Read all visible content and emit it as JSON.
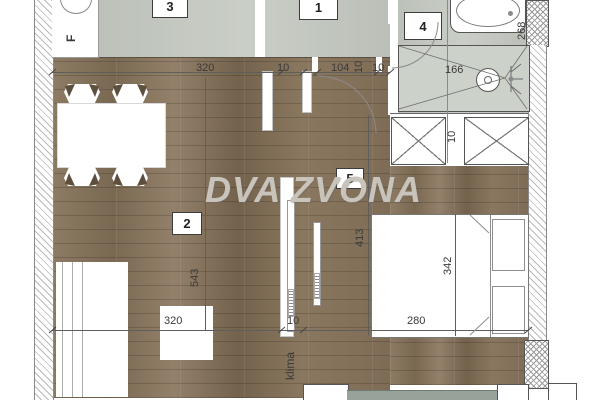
{
  "watermark": {
    "text": "DVA ZVONA"
  },
  "rooms": {
    "r1": "1",
    "r2": "2",
    "r3": "3",
    "r4": "4",
    "r5": "5"
  },
  "labels": {
    "fridge": "F",
    "klima": "klima"
  },
  "dims": {
    "top": {
      "d320": "320",
      "d10a": "10",
      "d104": "104",
      "d10b": "10",
      "d10c": "10"
    },
    "bath": {
      "d166": "166",
      "d268": "268"
    },
    "wardrobe": {
      "d10": "10"
    },
    "living": {
      "d543": "543"
    },
    "bedroom": {
      "d413": "413",
      "d342": "342"
    },
    "bottom": {
      "d320": "320",
      "d10": "10",
      "d280": "280",
      "clip_left": "80",
      "clip_right": "80"
    }
  },
  "colors": {
    "wood": "#85735d",
    "tile": "#c6cbc3",
    "window_strip": "#97a29b",
    "watermark_gray": "#c9c4bb",
    "chair_accent": "#5e4e3d"
  }
}
